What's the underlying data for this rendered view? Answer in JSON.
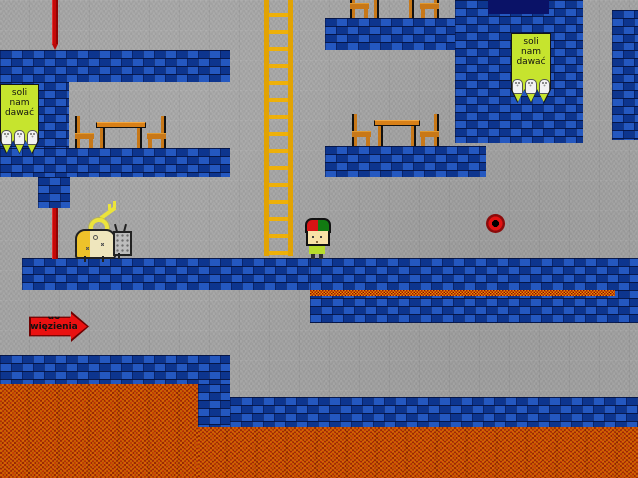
{
  "scene": {
    "type": "2d-platformer-level",
    "width": 638,
    "height": 478
  },
  "banners": [
    {
      "lines": [
        "soli",
        "nam",
        "dawać"
      ],
      "shaker_icons": 3
    },
    {
      "lines": [
        "soli",
        "nam",
        "dawać"
      ],
      "shaker_icons": 3
    }
  ],
  "sign": {
    "lines": [
      "do",
      "więzienia"
    ],
    "shape": "right-arrow"
  },
  "colors": {
    "concrete_bg": "#a4a4a4",
    "brick_blue": "#0f3da0",
    "brick_highlight": "#4682f5",
    "brick_mortar": "#04103c",
    "lava": "#b64005",
    "lava_strip": "#c41405",
    "ladder_gold": "#e2a303",
    "banner_green": "#c6e42e",
    "arrow_red": "#ea1111",
    "pole_red": "#c50808",
    "doorway_navy": "#0a1267",
    "key_yellow": "#ece43a",
    "player_cap_left": "#d81414",
    "player_cap_right": "#127a12",
    "player_shirt": "#b7dd2b",
    "robot_yellow": "#eec22a",
    "robot_cream": "#efe6bd",
    "furniture_orange": "#c87818",
    "orb_red": "#e21212"
  },
  "entities": [
    {
      "name": "player",
      "desc": "small character with half-red half-green cap standing on platform"
    },
    {
      "name": "robot-with-key",
      "desc": "yellow-cream robot creature carrying a yellow key"
    },
    {
      "name": "red-orb",
      "desc": "red ball with black center"
    },
    {
      "name": "ladder",
      "desc": "tall yellow ladder"
    },
    {
      "name": "salt-banner",
      "count": 2,
      "desc": "green banners reading 'soli nam dawać' with salt shakers"
    },
    {
      "name": "prison-arrow-sign",
      "desc": "red arrow sign reading 'do więzienia'"
    },
    {
      "name": "dining-set",
      "count": 3,
      "desc": "wooden table flanked by two chairs"
    },
    {
      "name": "lava-pool",
      "count": 2
    },
    {
      "name": "red-pole",
      "count": 2
    }
  ]
}
